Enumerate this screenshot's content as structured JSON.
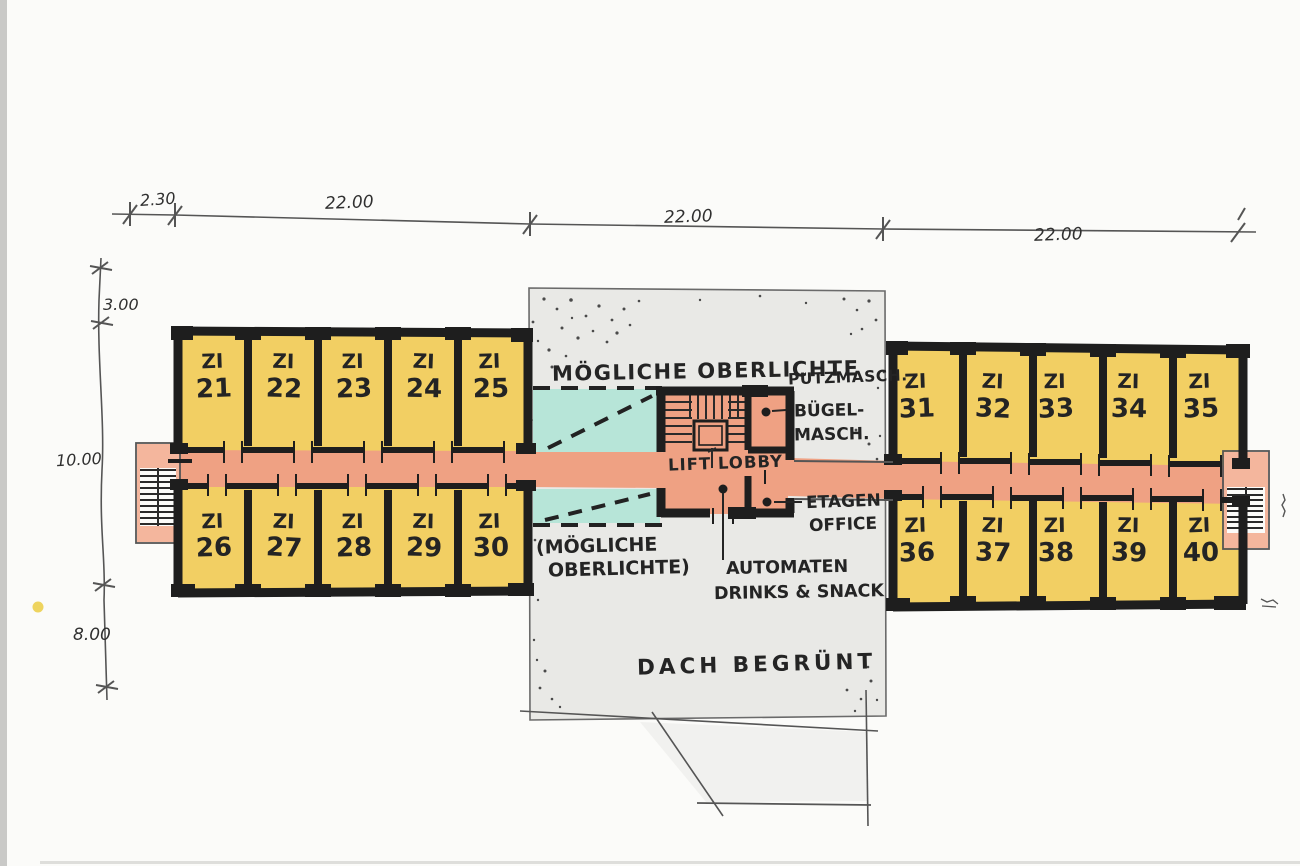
{
  "drawing": {
    "type": "hand-drawn floor plan sketch, hotel room floor",
    "rooms": {
      "left_top": [
        {
          "prefix": "ZI",
          "number": "21"
        },
        {
          "prefix": "ZI",
          "number": "22"
        },
        {
          "prefix": "ZI",
          "number": "23"
        },
        {
          "prefix": "ZI",
          "number": "24"
        },
        {
          "prefix": "ZI",
          "number": "25"
        }
      ],
      "left_bottom": [
        {
          "prefix": "ZI",
          "number": "26"
        },
        {
          "prefix": "ZI",
          "number": "27"
        },
        {
          "prefix": "ZI",
          "number": "28"
        },
        {
          "prefix": "ZI",
          "number": "29"
        },
        {
          "prefix": "ZI",
          "number": "30"
        }
      ],
      "right_top": [
        {
          "prefix": "ZI",
          "number": "31"
        },
        {
          "prefix": "ZI",
          "number": "32"
        },
        {
          "prefix": "ZI",
          "number": "33"
        },
        {
          "prefix": "ZI",
          "number": "34"
        },
        {
          "prefix": "ZI",
          "number": "35"
        }
      ],
      "right_bottom": [
        {
          "prefix": "ZI",
          "number": "36"
        },
        {
          "prefix": "ZI",
          "number": "37"
        },
        {
          "prefix": "ZI",
          "number": "38"
        },
        {
          "prefix": "ZI",
          "number": "39"
        },
        {
          "prefix": "ZI",
          "number": "40"
        }
      ]
    },
    "labels": {
      "oberlichte_top": "MÖGLICHE OBERLICHTE",
      "oberlichte_bottom_1": "(MÖGLICHE",
      "oberlichte_bottom_2": "OBERLICHTE)",
      "putzmasch": "PUTZMASCH.",
      "buegelmasch_1": "BÜGEL-",
      "buegelmasch_2": "MASCH.",
      "lift_lobby": "LIFT LOBBY",
      "etagen_office_1": "ETAGEN",
      "etagen_office_2": "OFFICE",
      "automaten_1": "AUTOMATEN",
      "automaten_2": "DRINKS & SNACK",
      "dach_begruent": "DACH BEGRÜNT"
    },
    "dimensions": {
      "top": [
        "2.30",
        "22.00",
        "22.00",
        "22.00"
      ],
      "left": [
        "3.00",
        "10.00",
        "8.00"
      ]
    }
  },
  "colors": {
    "paper": "#fbfbf9",
    "roomYellow": "#f2cf63",
    "corridorSalmon": "#efa183",
    "salmonLight": "#f4b69d",
    "skylightTeal": "#b7e5d8",
    "roofGray": "#e9e9e6",
    "wallBlack": "#1e1e1e",
    "pencil": "#555555"
  }
}
